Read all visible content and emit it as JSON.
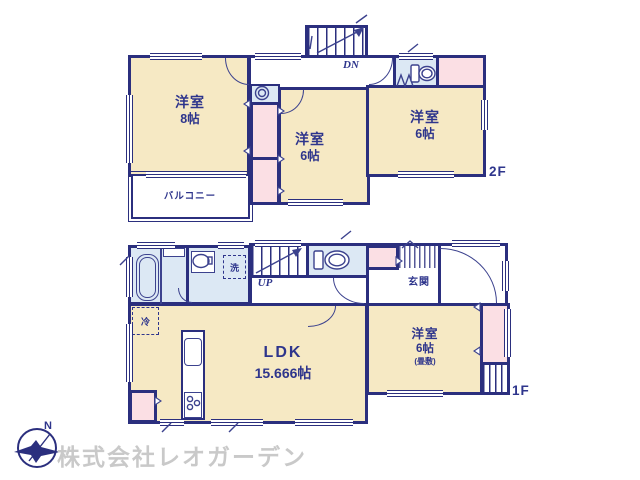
{
  "compass": {
    "north_label": "N"
  },
  "watermark": {
    "company_name": "株式会社レオガーデン"
  },
  "colors": {
    "wall_navy": "#2b2f7e",
    "room_cream": "#f6e9c4",
    "closet_pink": "#fbdfe4",
    "wet_area_blue": "#dce8f4",
    "watermark_gray": "#c9c9c9"
  },
  "floor_2f": {
    "floor_label": "2F",
    "stair_label": "DN",
    "room_west": {
      "type": "洋室",
      "size": "8帖"
    },
    "room_center": {
      "type": "洋室",
      "size": "6帖"
    },
    "room_east": {
      "type": "洋室",
      "size": "6帖"
    },
    "balcony_label": "バルコニー"
  },
  "floor_1f": {
    "floor_label": "1F",
    "stair_label": "UP",
    "ldk": {
      "type": "LDK",
      "size": "15.666帖"
    },
    "room_east": {
      "type": "洋室",
      "size": "6帖",
      "note": "(畳敷)"
    },
    "entrance_label": "玄関",
    "laundry_label": "洗",
    "refrigerator_label": "冷"
  }
}
